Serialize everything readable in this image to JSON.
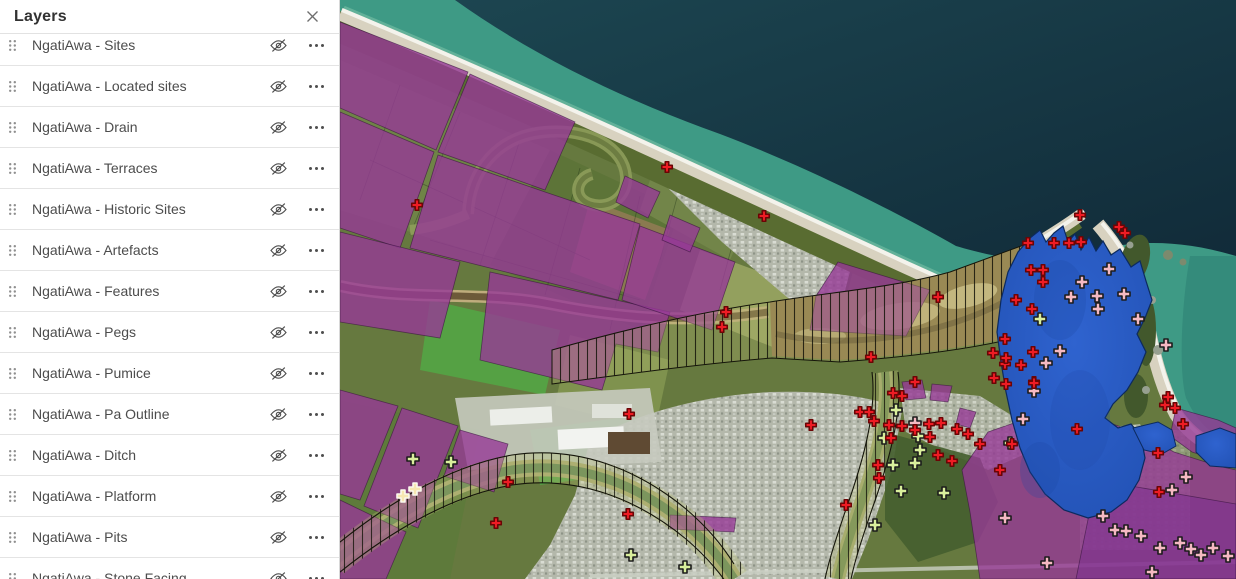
{
  "panel": {
    "title": "Layers",
    "close_icon": "x-icon",
    "row_icons": {
      "drag": "six-dot-grip",
      "visibility": "eye-slash (layer hidden)",
      "options": "ellipsis-menu"
    },
    "items": [
      {
        "label": "NgatiAwa - Sites",
        "visibility": "hidden"
      },
      {
        "label": "NgatiAwa - Located sites",
        "visibility": "hidden"
      },
      {
        "label": "NgatiAwa - Drain",
        "visibility": "hidden"
      },
      {
        "label": "NgatiAwa - Terraces",
        "visibility": "hidden"
      },
      {
        "label": "NgatiAwa - Historic Sites",
        "visibility": "hidden"
      },
      {
        "label": "NgatiAwa - Artefacts",
        "visibility": "hidden"
      },
      {
        "label": "NgatiAwa - Features",
        "visibility": "hidden"
      },
      {
        "label": "NgatiAwa - Pegs",
        "visibility": "hidden"
      },
      {
        "label": "NgatiAwa - Pumice",
        "visibility": "hidden"
      },
      {
        "label": "NgatiAwa - Pa Outline",
        "visibility": "hidden"
      },
      {
        "label": "NgatiAwa - Ditch",
        "visibility": "hidden"
      },
      {
        "label": "NgatiAwa - Platform",
        "visibility": "hidden"
      },
      {
        "label": "NgatiAwa - Pits",
        "visibility": "hidden"
      },
      {
        "label": "NgatiAwa - Stone Facing",
        "visibility": "hidden"
      }
    ]
  },
  "map": {
    "type": "satellite-basemap-with-overlays",
    "colors": {
      "ocean_deep": "#13323e",
      "ocean_nearshore": "#3e9a85",
      "estuary_blue": "#2b5ac4",
      "parcel_purple": "#963a96",
      "hatch_tint": "#b9bd74",
      "beach_sand": "#d8d2c0"
    },
    "marker_style": {
      "pink": {
        "fill": "#f5b9c2",
        "stroke": "#1c1c1c",
        "size": 12
      },
      "cream": {
        "fill": "#f7e7b2",
        "stroke": "#fbf9ee",
        "size": 12
      },
      "green": {
        "fill": "#d9ef9c",
        "stroke": "#1c1c1c",
        "size": 12
      },
      "red": {
        "fill": "#ee1c24",
        "stroke": "#6b0505",
        "size": 10.5
      }
    },
    "markers": {
      "pink": [
        [
          769,
          269
        ],
        [
          742,
          282
        ],
        [
          731,
          297
        ],
        [
          757,
          296
        ],
        [
          784,
          294
        ],
        [
          758,
          309
        ],
        [
          798,
          319
        ],
        [
          720,
          351
        ],
        [
          706,
          363
        ],
        [
          826,
          345
        ],
        [
          694,
          391
        ],
        [
          683,
          419
        ],
        [
          763,
          516
        ],
        [
          775,
          530
        ],
        [
          786,
          531
        ],
        [
          801,
          536
        ],
        [
          820,
          548
        ],
        [
          851,
          549
        ],
        [
          861,
          555
        ],
        [
          873,
          548
        ],
        [
          888,
          556
        ],
        [
          812,
          572
        ],
        [
          846,
          477
        ],
        [
          832,
          490
        ],
        [
          665,
          518
        ],
        [
          707,
          563
        ],
        [
          840,
          543
        ],
        [
          575,
          423
        ]
      ],
      "cream": [
        [
          63,
          496
        ],
        [
          75,
          489
        ]
      ],
      "green": [
        [
          73,
          459
        ],
        [
          111,
          462
        ],
        [
          556,
          410
        ],
        [
          544,
          438
        ],
        [
          578,
          436
        ],
        [
          580,
          450
        ],
        [
          553,
          465
        ],
        [
          604,
          493
        ],
        [
          291,
          555
        ],
        [
          345,
          567
        ],
        [
          700,
          319
        ],
        [
          670,
          443
        ],
        [
          535,
          525
        ],
        [
          575,
          463
        ],
        [
          561,
          491
        ]
      ],
      "red": [
        [
          77,
          205
        ],
        [
          327,
          167
        ],
        [
          424,
          216
        ],
        [
          386,
          312
        ],
        [
          382,
          327
        ],
        [
          531,
          357
        ],
        [
          598,
          297
        ],
        [
          168,
          482
        ],
        [
          156,
          523
        ],
        [
          289,
          414
        ],
        [
          288,
          514
        ],
        [
          471,
          425
        ],
        [
          506,
          505
        ],
        [
          520,
          412
        ],
        [
          529,
          412
        ],
        [
          534,
          421
        ],
        [
          549,
          425
        ],
        [
          562,
          426
        ],
        [
          575,
          430
        ],
        [
          589,
          424
        ],
        [
          601,
          423
        ],
        [
          617,
          429
        ],
        [
          628,
          434
        ],
        [
          551,
          438
        ],
        [
          590,
          437
        ],
        [
          562,
          396
        ],
        [
          553,
          393
        ],
        [
          575,
          382
        ],
        [
          538,
          465
        ],
        [
          539,
          478
        ],
        [
          598,
          455
        ],
        [
          612,
          461
        ],
        [
          640,
          444
        ],
        [
          653,
          353
        ],
        [
          665,
          339
        ],
        [
          665,
          364
        ],
        [
          681,
          365
        ],
        [
          654,
          378
        ],
        [
          694,
          382
        ],
        [
          672,
          444
        ],
        [
          740,
          215
        ],
        [
          779,
          227
        ],
        [
          785,
          233
        ],
        [
          688,
          243
        ],
        [
          714,
          243
        ],
        [
          729,
          243
        ],
        [
          741,
          242
        ],
        [
          691,
          270
        ],
        [
          703,
          270
        ],
        [
          703,
          282
        ],
        [
          692,
          309
        ],
        [
          693,
          352
        ],
        [
          666,
          358
        ],
        [
          737,
          429
        ],
        [
          818,
          453
        ],
        [
          819,
          492
        ],
        [
          825,
          405
        ],
        [
          835,
          408
        ],
        [
          828,
          397
        ],
        [
          843,
          424
        ],
        [
          666,
          384
        ],
        [
          694,
          383
        ],
        [
          676,
          300
        ],
        [
          660,
          470
        ]
      ]
    }
  }
}
